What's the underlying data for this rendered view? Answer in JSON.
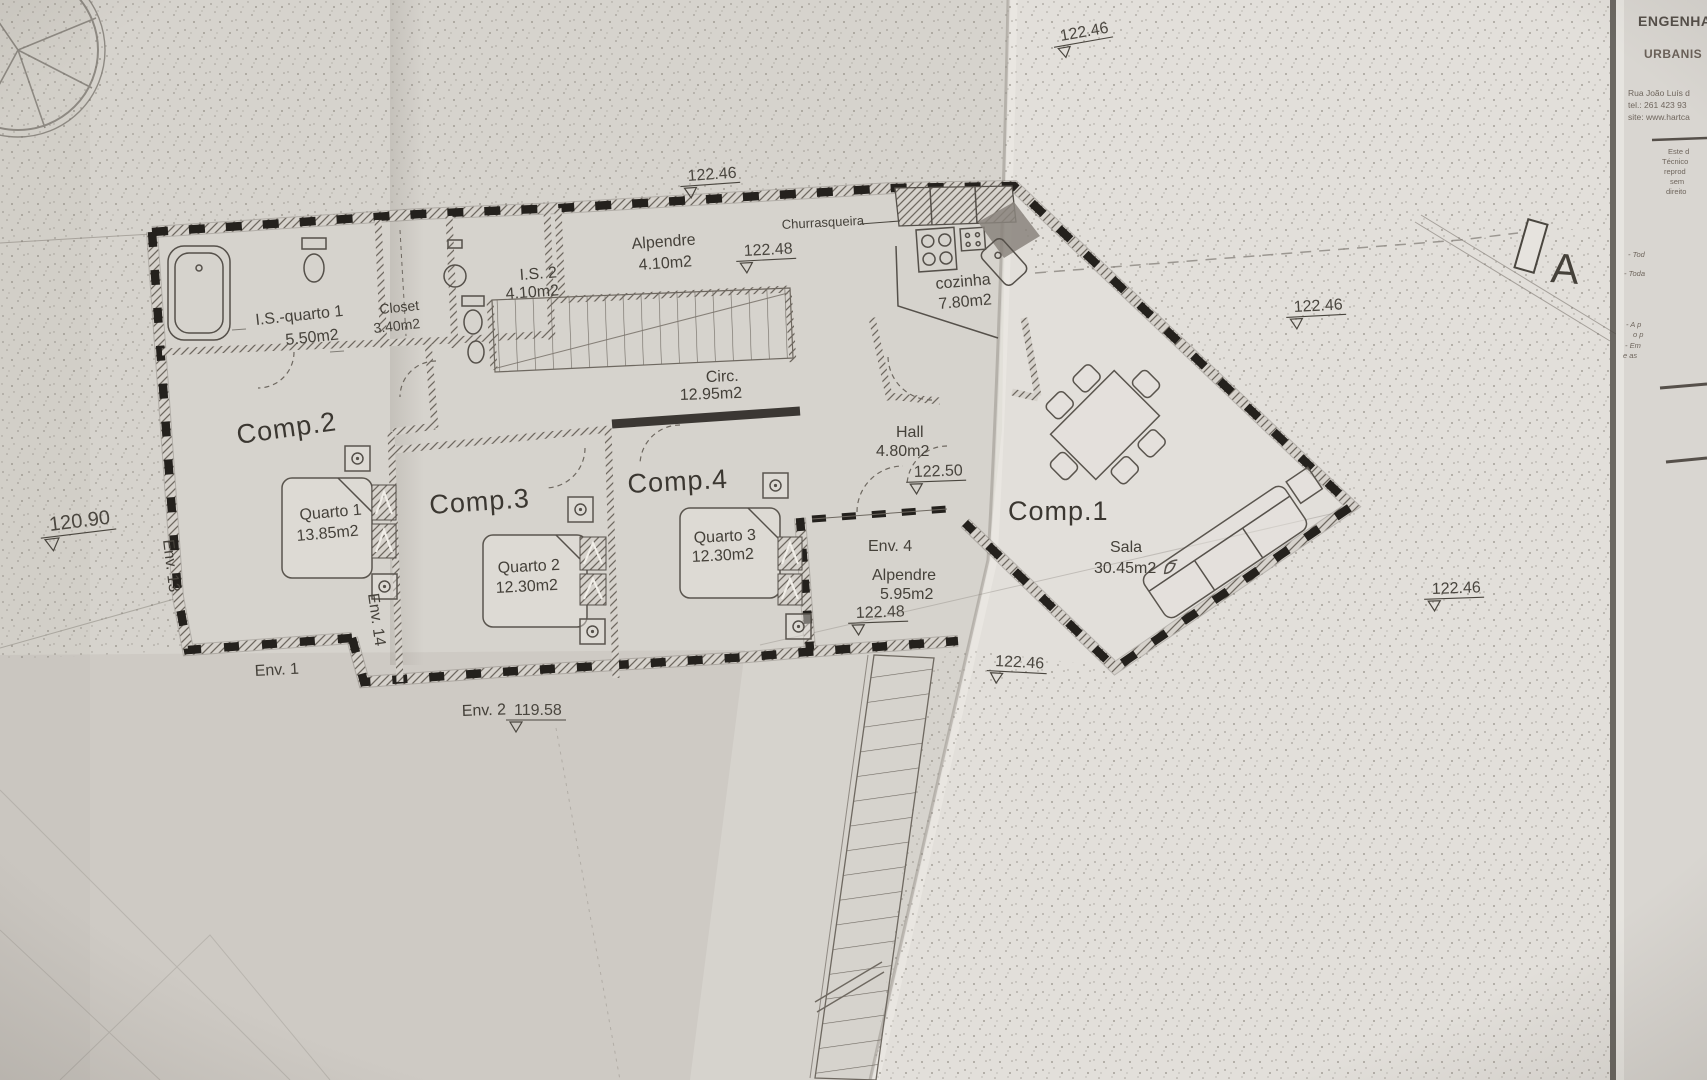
{
  "photo": {
    "paper_color": "#e2dfda",
    "fold_shadow": "#8c8478",
    "line_color": "#4a463f",
    "wall_color": "#24211d"
  },
  "title_block": {
    "company_line1": "ENGENHA",
    "company_line2": "URBANIS",
    "address_line1": "Rua João Luís d",
    "address_line2": "tel.: 261 423 93",
    "address_line3": "site: www.hartca",
    "disclaimer": [
      "Este d",
      "Técnico",
      "reprod",
      "sem",
      "direito"
    ],
    "notes": [
      "- Tod",
      "- Toda",
      "- A p",
      "o p",
      "- Em",
      "e as"
    ]
  },
  "section_marker": {
    "label": "A"
  },
  "rooms": {
    "alpendre_top": {
      "name": "Alpendre",
      "area": "4.10m2"
    },
    "churrasqueira": {
      "name": "Churrasqueira"
    },
    "is_quarto1": {
      "name": "I.S.-quarto 1",
      "area": "5.50m2"
    },
    "closet": {
      "name": "Closet",
      "area": "3.40m2"
    },
    "is2": {
      "name": "I.S. 2",
      "area": "4.10m2"
    },
    "cozinha": {
      "name": "cozinha",
      "area": "7.80m2"
    },
    "circ": {
      "name": "Circ.",
      "area": "12.95m2"
    },
    "hall": {
      "name": "Hall",
      "area": "4.80m2"
    },
    "comp1": {
      "name": "Comp.1"
    },
    "sala": {
      "name": "Sala",
      "area": "30.45m2"
    },
    "comp2": {
      "name": "Comp.2"
    },
    "quarto1": {
      "name": "Quarto 1",
      "area": "13.85m2"
    },
    "comp3": {
      "name": "Comp.3"
    },
    "quarto2": {
      "name": "Quarto 2",
      "area": "12.30m2"
    },
    "comp4": {
      "name": "Comp.4"
    },
    "quarto3": {
      "name": "Quarto 3",
      "area": "12.30m2"
    },
    "env4": {
      "name": "Env. 4"
    },
    "alpendre_env4": {
      "name": "Alpendre",
      "area": "5.95m2"
    }
  },
  "envelopes": {
    "env1": "Env. 1",
    "env2": "Env. 2",
    "env13": "Env. 13",
    "env14": "Env. 14"
  },
  "elevations": {
    "top_center": "122.46",
    "top_fold": "122.46",
    "alpendre_top": "122.48",
    "right_mid": "122.46",
    "hall": "122.50",
    "env4": "122.48",
    "below_env2": "122.46",
    "bottom_right": "122.46",
    "west": "120.90",
    "south": "119.58"
  }
}
